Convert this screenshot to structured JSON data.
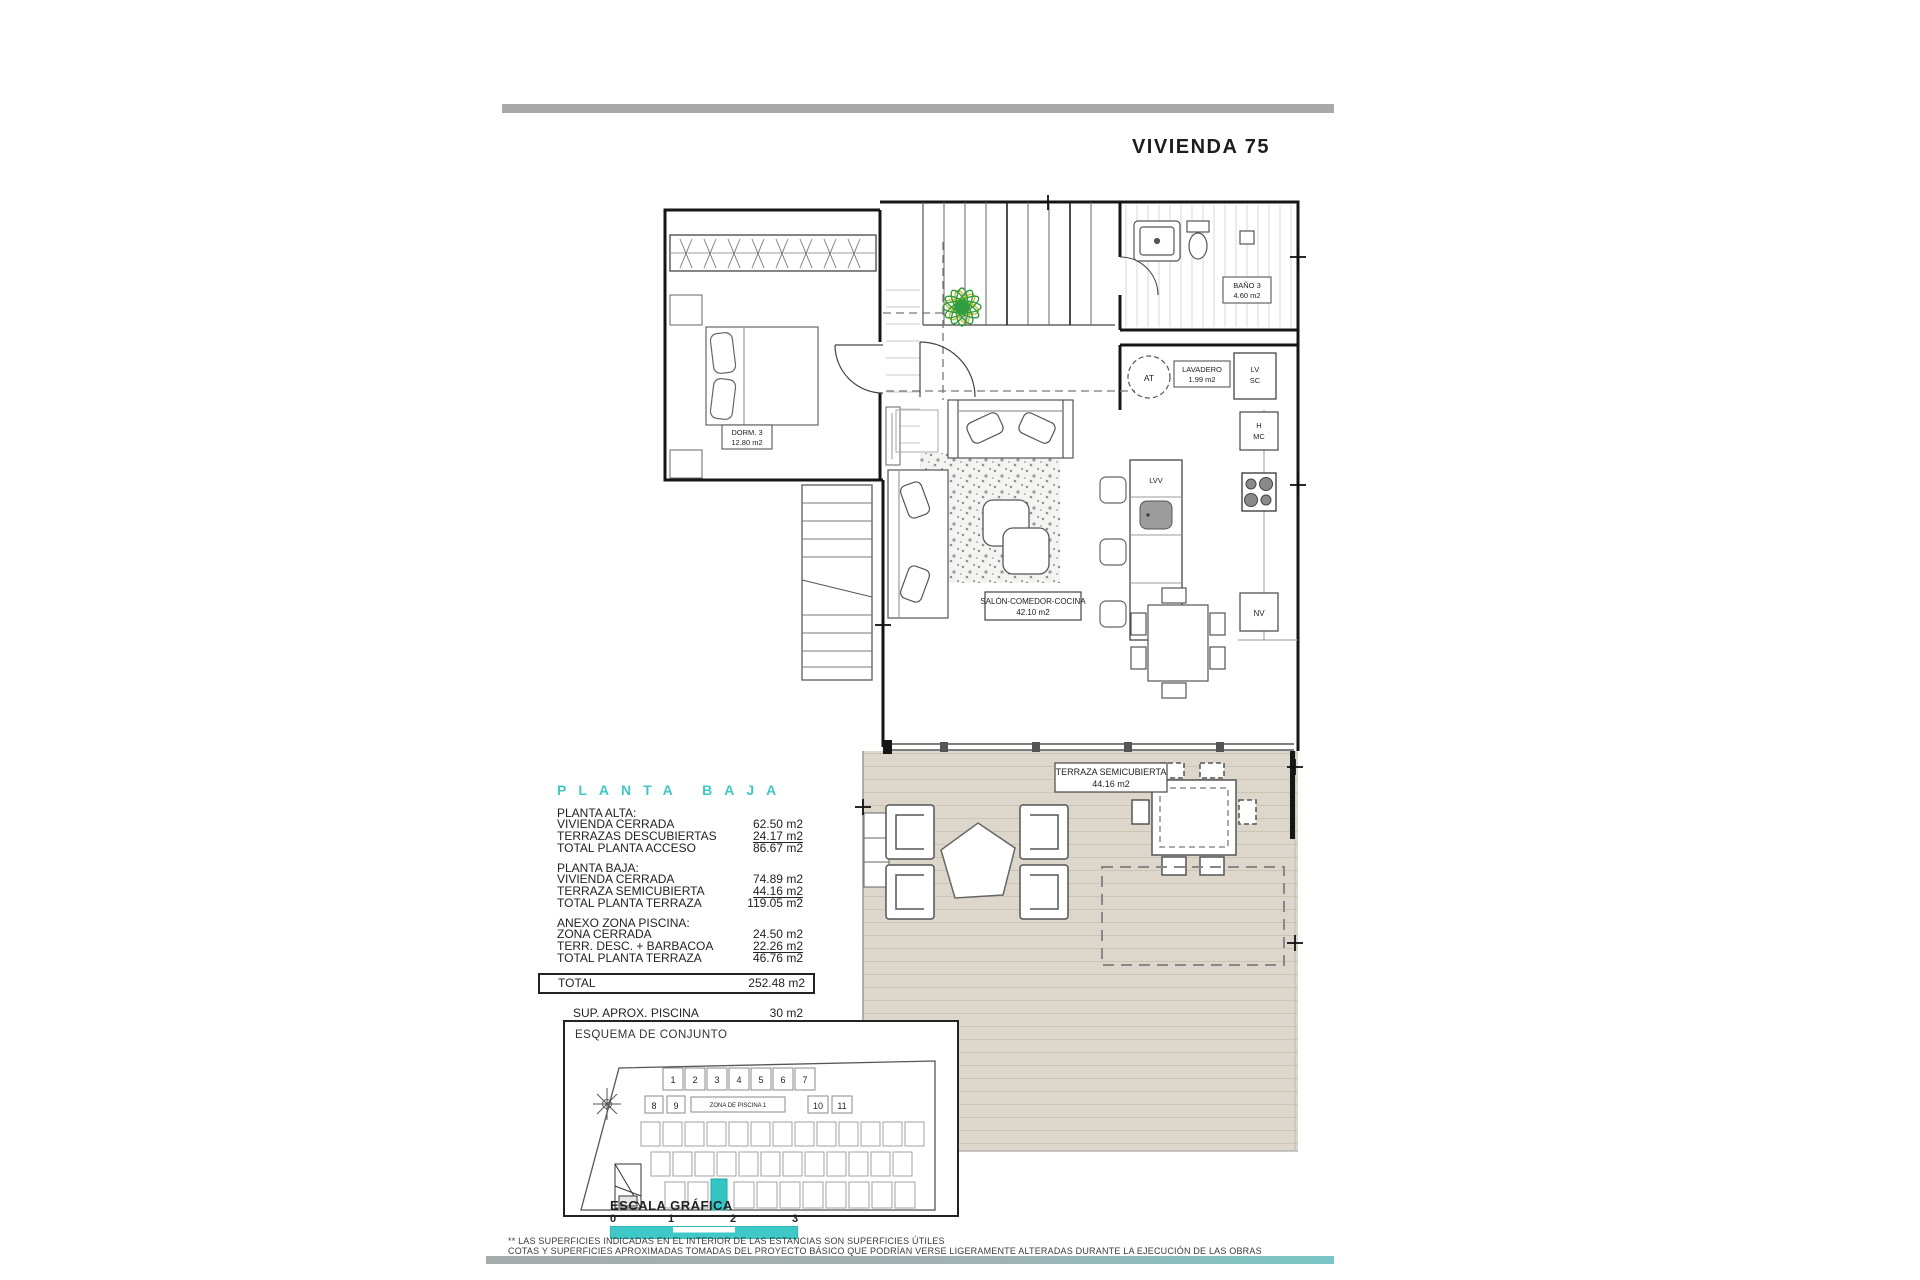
{
  "page": {
    "title": "VIVIENDA 75"
  },
  "plan": {
    "dorm_name": "DORM. 3",
    "dorm_area": "12.80 m2",
    "bano_name": "BAÑO 3",
    "bano_area": "4.60 m2",
    "lavadero_name": "LAVADERO",
    "lavadero_area": "1.99 m2",
    "salon_name": "SALÓN-COMEDOR-COCINA",
    "salon_area": "42.10 m2",
    "terraza_name": "TERRAZA SEMICUBIERTA",
    "terraza_area": "44.16 m2",
    "at": "AT",
    "lv": "LV",
    "sc": "SC",
    "h": "H",
    "mc": "MC",
    "nv": "NV",
    "lvv": "LVV"
  },
  "summary": {
    "heading": "PLANTA BAJA",
    "sections": [
      {
        "title": "PLANTA ALTA:",
        "rows": [
          {
            "label": "VIVIENDA CERRADA",
            "value": "62.50 m2"
          },
          {
            "label": "TERRAZAS DESCUBIERTAS",
            "value": "24.17 m2"
          },
          {
            "label": "TOTAL PLANTA ACCESO",
            "value": "86.67 m2"
          }
        ]
      },
      {
        "title": "PLANTA BAJA:",
        "rows": [
          {
            "label": "VIVIENDA CERRADA",
            "value": "74.89 m2"
          },
          {
            "label": "TERRAZA SEMICUBIERTA",
            "value": "44.16 m2"
          },
          {
            "label": "TOTAL PLANTA TERRAZA",
            "value": "119.05 m2"
          }
        ]
      },
      {
        "title": "ANEXO ZONA PISCINA:",
        "rows": [
          {
            "label": "ZONA CERRADA",
            "value": "24.50 m2"
          },
          {
            "label": "TERR. DESC. + BARBACOA",
            "value": "22.26 m2"
          },
          {
            "label": "TOTAL PLANTA TERRAZA",
            "value": "46.76 m2"
          }
        ]
      }
    ],
    "total": {
      "label": "TOTAL",
      "value": "252.48 m2"
    },
    "extras": [
      {
        "label": "SUP.  APROX.  PISCINA",
        "value": "30 m2"
      },
      {
        "label": "SUP.  APROX.  PARCELA",
        "value": "400 m2"
      }
    ]
  },
  "esquema": {
    "title": "ESQUEMA DE CONJUNTO",
    "zona_label": "ZONA DE PISCINA 1",
    "plot_numbers": [
      "1",
      "2",
      "3",
      "4",
      "5",
      "6",
      "7",
      "8",
      "9",
      "10",
      "11"
    ]
  },
  "escala": {
    "title": "ESCALA GRÁFICA",
    "ticks": [
      "0",
      "1",
      "2",
      "3"
    ]
  },
  "footer": {
    "line1": "** LAS SUPERFICIES INDICADAS EN EL INTERIOR DE LAS ESTANCIAS SON SUPERFICIES ÚTILES",
    "line2": "COTAS Y SUPERFICIES APROXIMADAS TOMADAS DEL PROYECTO BÁSICO QUE PODRÍAN VERSE LIGERAMENTE ALTERADAS DURANTE LA EJECUCIÓN DE LAS OBRAS"
  },
  "colors": {
    "accent_teal": "#3fc8c8",
    "bar_gray": "#a9a9a9",
    "terrace_beige": "#dcd7ca"
  }
}
